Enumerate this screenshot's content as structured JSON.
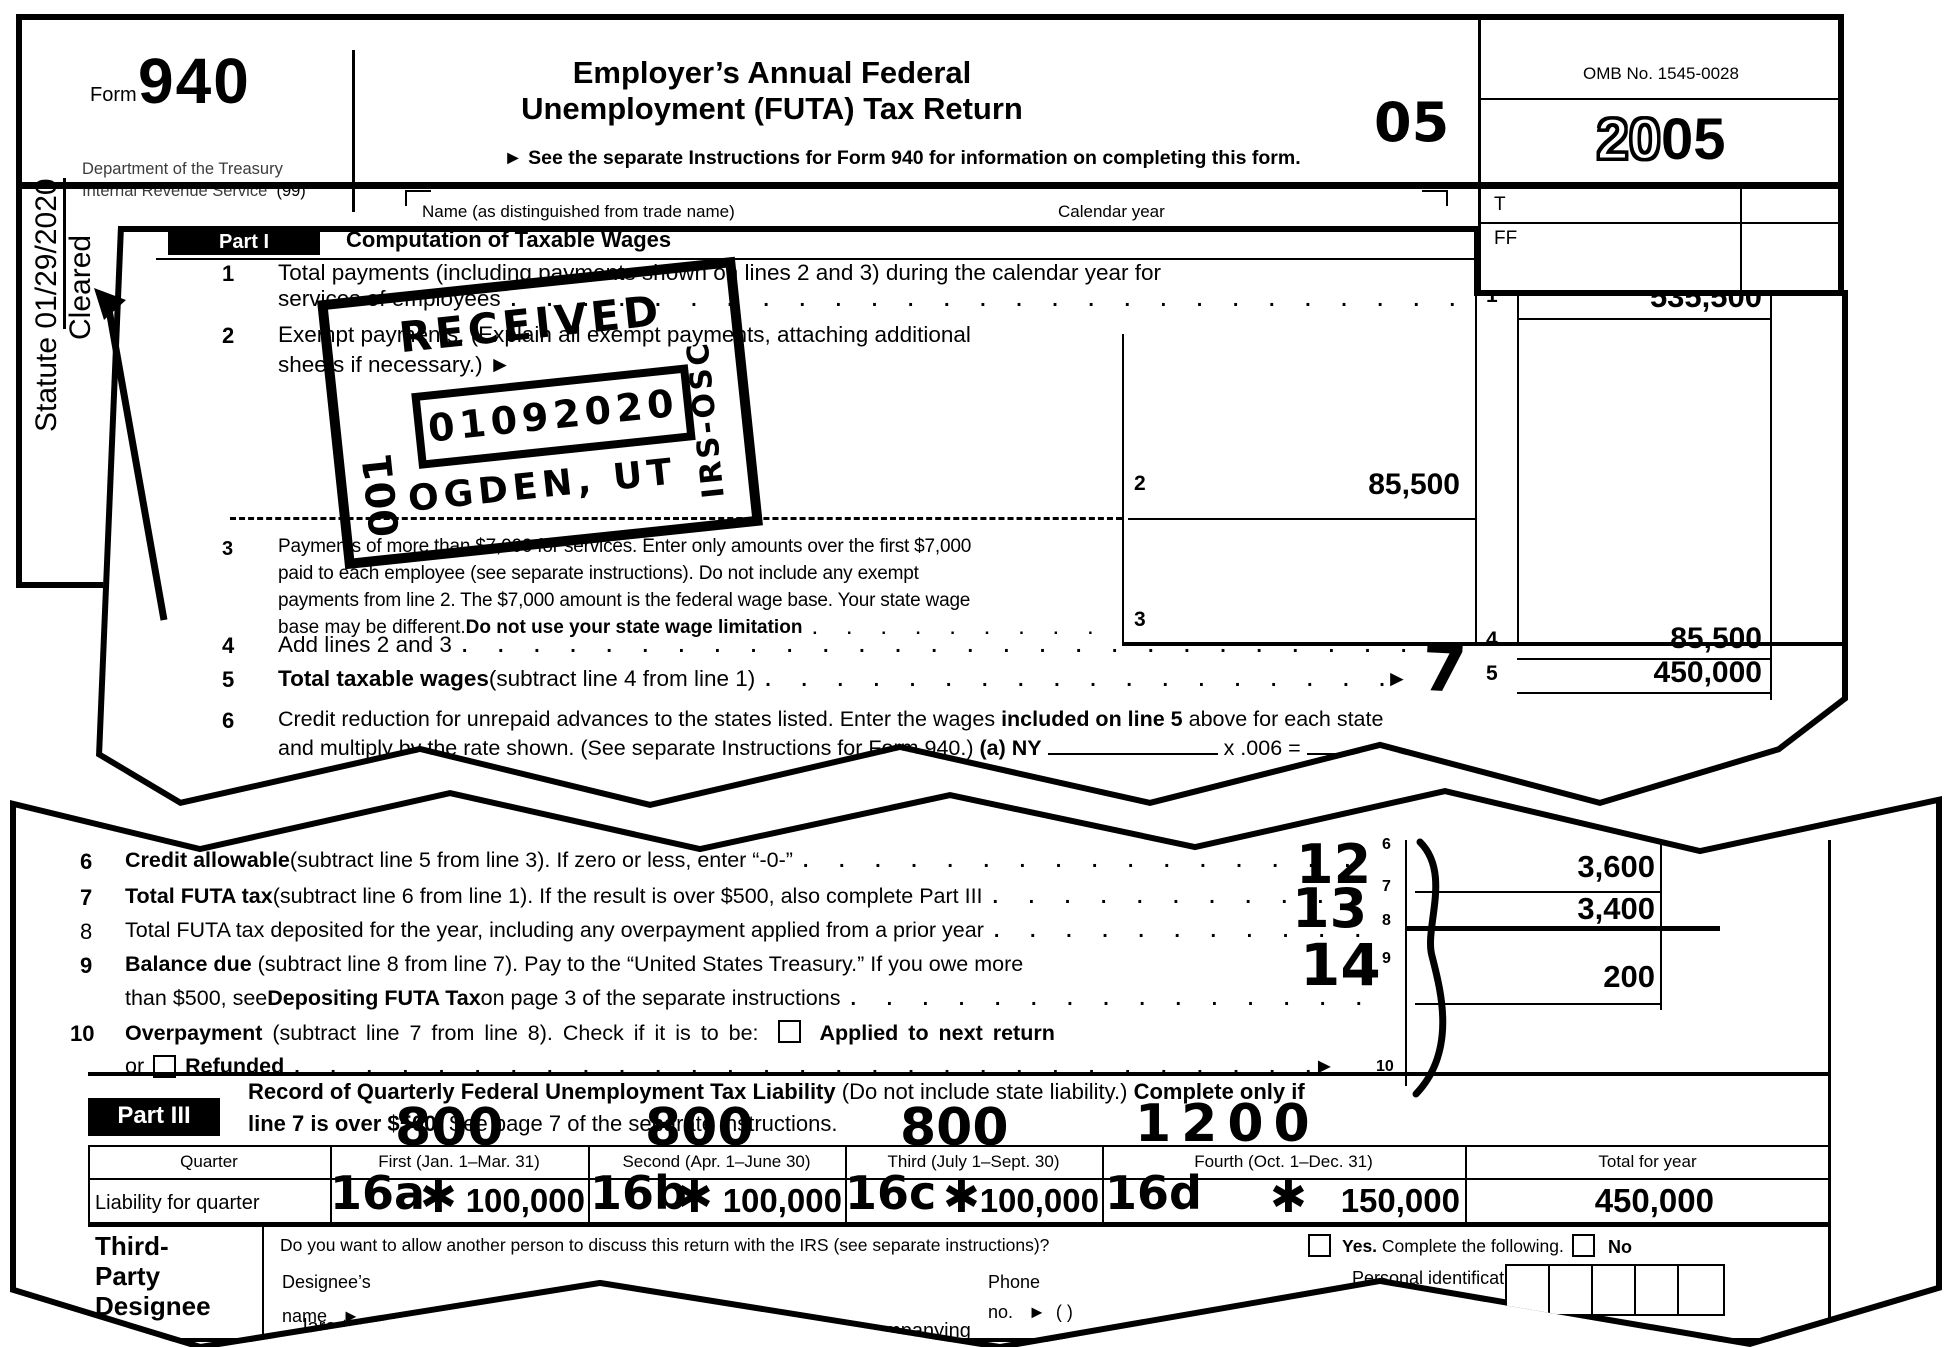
{
  "dots": ". . . . . . . . . . . . . . . . . . . . . . . . . . . . . . . . . . . . . . . . . . . . . . . . . . . . . . . . . . . .",
  "annotations": {
    "statute_label": "Statute",
    "statute_date": "01/29/2020",
    "cleared": "Cleared",
    "page_code": "05",
    "line5_mark": "7",
    "line7_mark": "12",
    "line8_mark": "13",
    "line9_mark": "14",
    "quarter_marks": {
      "q1": "800",
      "q2": "800",
      "q3": "800",
      "q4": "1200"
    },
    "quarter_refs": {
      "q1": "16a",
      "q2": "16b",
      "q3": "16c",
      "q4": "16d"
    },
    "check_mark": "✱",
    "stamp": {
      "received": "RECEIVED",
      "date": "01092020",
      "office": "OGDEN, UT",
      "side": "IRS-OSC",
      "code": "001"
    }
  },
  "page1": {
    "form_label": "Form",
    "form_number": "940",
    "dept_line1": "Department of the Treasury",
    "dept_line2": "Internal Revenue Service",
    "dept_suffix": "(99)",
    "title_line1": "Employer’s Annual Federal",
    "title_line2": "Unemployment (FUTA) Tax Return",
    "instructions": "► See the separate Instructions for Form 940 for information on completing this form.",
    "omb": "OMB No. 1545-0028",
    "year_outline": "20",
    "year_bold": "05",
    "t_label": "T",
    "ff_label": "FF",
    "name_label": "Name (as distinguished from trade name)",
    "calendar_label": "Calendar year"
  },
  "page2": {
    "part_label": "Part I",
    "part_heading": "Computation of Taxable Wages",
    "line1": {
      "num": "1",
      "text1": "Total payments (including payments shown on lines 2 and 3) during the calendar year for",
      "text2": "services of employees",
      "col": "1",
      "value": "535,500"
    },
    "line2": {
      "num": "2",
      "text1": "Exempt payments. (Explain all exempt payments, attaching additional",
      "text2": "sheets if necessary.) ►",
      "col": "2",
      "value": "85,500"
    },
    "line3": {
      "num": "3",
      "text1": "Payments of more than $7,000 for services. Enter only amounts over the first $7,000",
      "text2": "paid to each employee (see separate instructions). Do not include any exempt",
      "text3": "payments from line 2. The $7,000 amount is the federal wage base. Your state wage",
      "text4a": "base may be different. ",
      "text4b": "Do not use your state wage limitation",
      "col": "3"
    },
    "line4": {
      "num": "4",
      "text": "Add lines 2 and 3",
      "col": "4",
      "value": "85,500"
    },
    "line5": {
      "num": "5",
      "bold": "Total taxable wages",
      "rest": " (subtract line 4 from line 1)",
      "arrow": "►",
      "col": "5",
      "value": "450,000"
    },
    "line6": {
      "num": "6",
      "text1a": "Credit reduction for unrepaid advances to the states listed. Enter the wages ",
      "text1b": "included on line 5",
      "text1c": " above for each state",
      "text2a": "and multiply by the rate shown. (See separate Instructions for Form 940.) ",
      "text2b": "(a) NY",
      "text2c": "x .006 ="
    }
  },
  "page3": {
    "line6": {
      "num": "6",
      "bold": "Credit allowable",
      "rest": " (subtract line 5 from line 3). If zero or less, enter “-0-”",
      "col": "6"
    },
    "line7": {
      "num": "7",
      "bold": "Total FUTA tax",
      "rest": " (subtract line 6 from line 1). If the result is over $500, also complete Part III",
      "col": "7",
      "value": "3,600"
    },
    "line8": {
      "num": "8",
      "text": "Total FUTA tax deposited for the year, including any overpayment applied from a prior year",
      "col": "8",
      "value": "3,400"
    },
    "line9": {
      "num": "9",
      "bold": "Balance due",
      "rest1": " (subtract line 8 from line 7). Pay to the “United States Treasury.” If you owe more",
      "text2a": "than $500, see ",
      "text2b": "Depositing FUTA Tax",
      "text2c": " on page 3 of the separate instructions",
      "col": "9",
      "value": "200"
    },
    "line10": {
      "num": "10",
      "bold": "Overpayment",
      "rest": " (subtract line 7 from line 8). Check if it is to be:",
      "applied": "Applied to next return",
      "or_label": "or",
      "refunded": "Refunded",
      "arrow": "►",
      "col": "10"
    },
    "part3": {
      "label": "Part III",
      "h1a": "Record of Quarterly Federal Unemployment Tax Liability",
      "h1b": " (Do not include state liability.) ",
      "h1c": "Complete only if",
      "h2a": "line 7 is over $500.",
      "h2b": " See page 7 of the separate instructions."
    },
    "table": {
      "headers": [
        "Quarter",
        "First (Jan. 1–Mar. 31)",
        "Second (Apr. 1–June 30)",
        "Third (July 1–Sept. 30)",
        "Fourth (Oct. 1–Dec. 31)",
        "Total for year"
      ],
      "row_label": "Liability for quarter",
      "values": [
        "100,000",
        "100,000",
        "100,000",
        "150,000",
        "450,000"
      ]
    },
    "designee": {
      "label1": "Third-",
      "label2": "Party",
      "label3": "Designee",
      "question": "Do you want to allow another person to discuss this return with the IRS (see separate instructions)?",
      "yes_bold": "Yes.",
      "yes_rest": " Complete the following.",
      "no_label": "No",
      "designee1": "Designee’s",
      "designee2": "name",
      "arrow": "►",
      "phone1": "Phone",
      "phone2": "no.",
      "phone_paren": "(      )",
      "pin1": "Personal identification",
      "pin2": "number (PIN)"
    },
    "fragments": [
      "lare that I hav",
      "companying",
      "the best of m"
    ]
  }
}
